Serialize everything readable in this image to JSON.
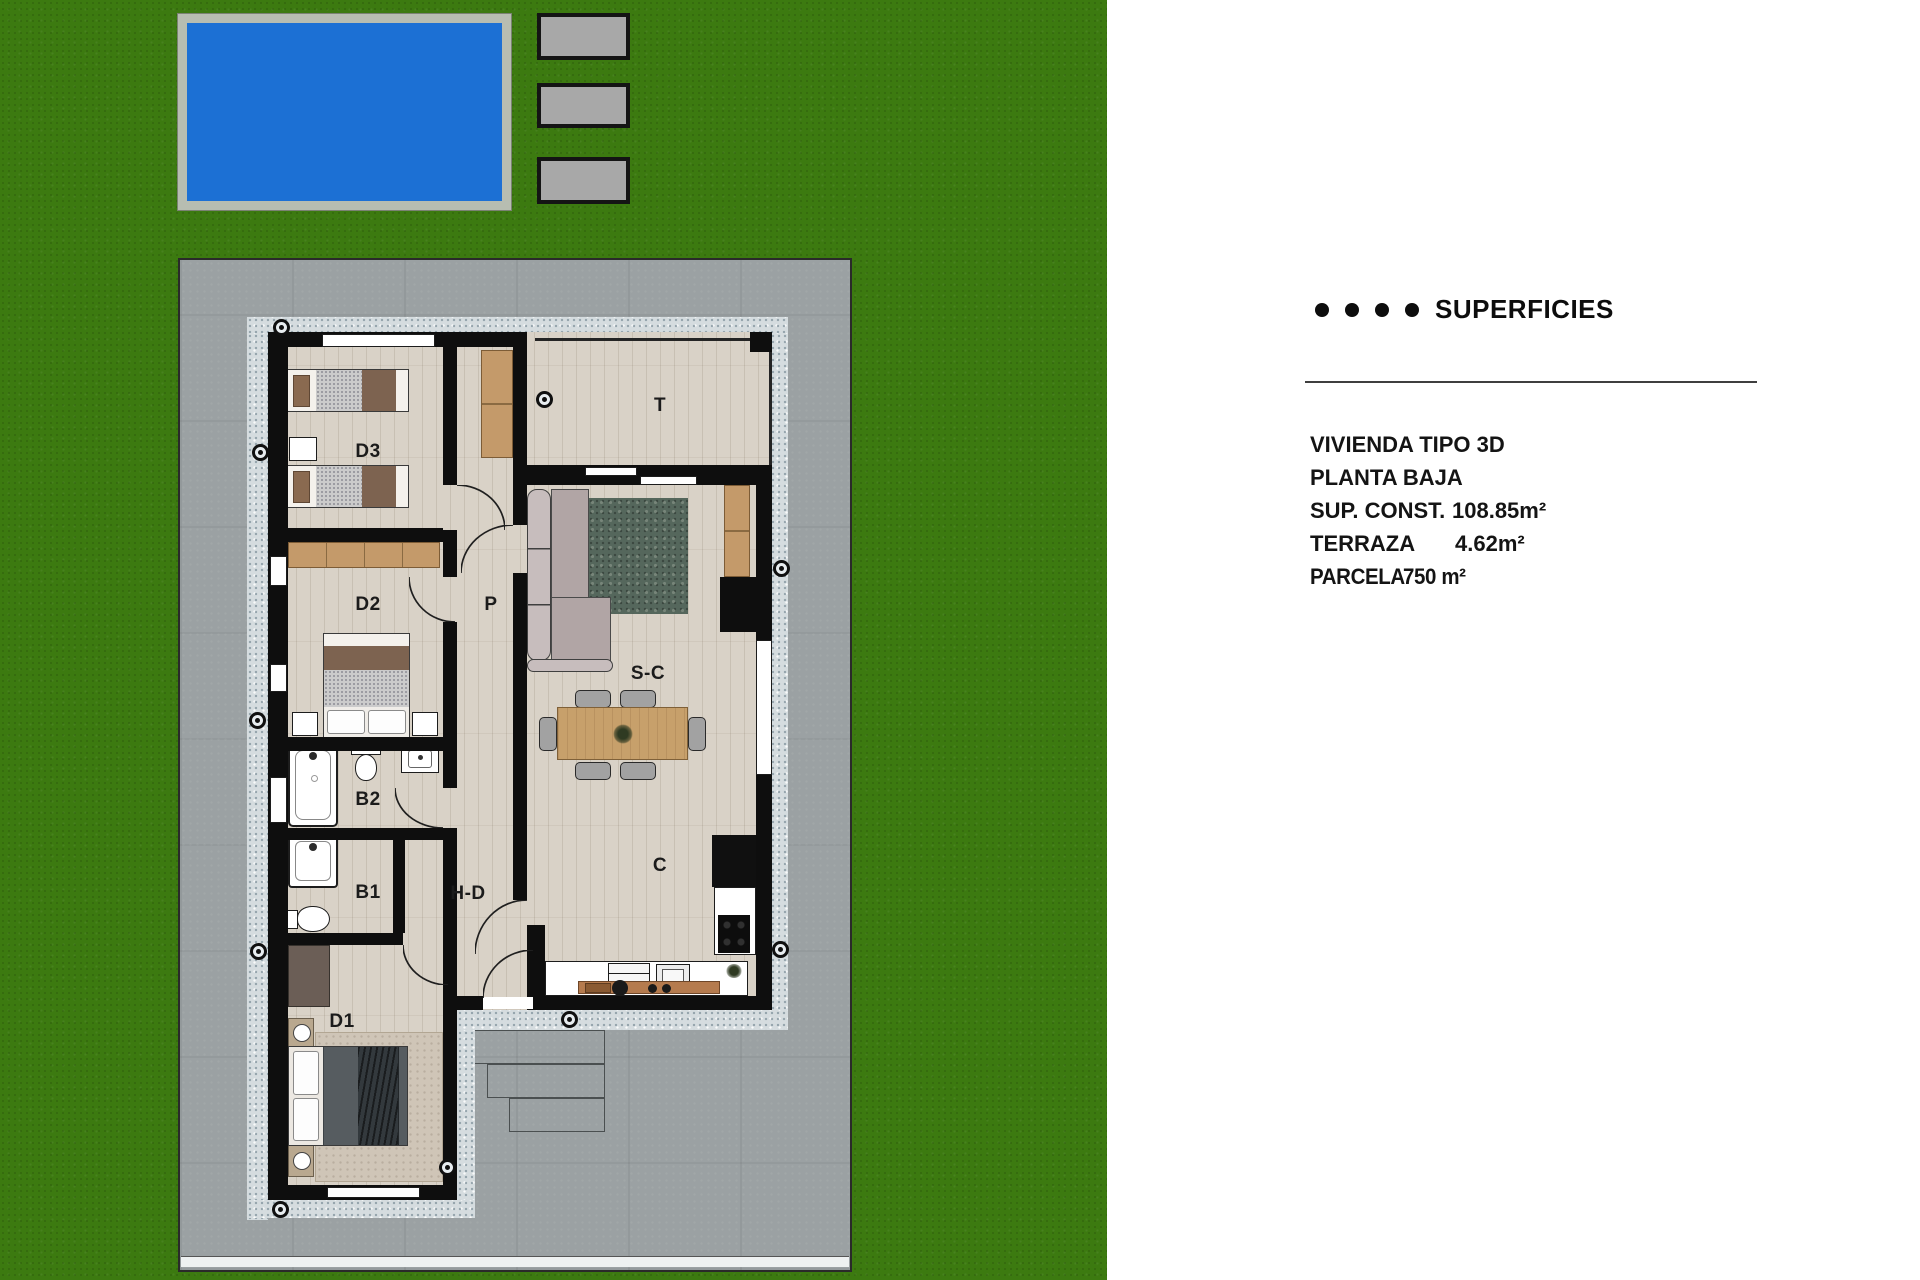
{
  "panel": {
    "title": "SUPERFICIES",
    "lines": [
      {
        "text": "VIVIENDA TIPO 3D"
      },
      {
        "text": "PLANTA BAJA"
      },
      {
        "label": "SUP. CONST.",
        "value": "108.85m²"
      },
      {
        "label": "TERRAZA",
        "value": "4.62m²"
      },
      {
        "label": "PARCELA",
        "value": "750 m²"
      }
    ]
  },
  "plan": {
    "room_labels": [
      {
        "id": "d3",
        "text": "D3",
        "x": 368,
        "y": 452
      },
      {
        "id": "d2",
        "text": "D2",
        "x": 368,
        "y": 605
      },
      {
        "id": "p",
        "text": "P",
        "x": 491,
        "y": 605
      },
      {
        "id": "t",
        "text": "T",
        "x": 660,
        "y": 406
      },
      {
        "id": "sc",
        "text": "S-C",
        "x": 648,
        "y": 674
      },
      {
        "id": "b2",
        "text": "B2",
        "x": 368,
        "y": 800
      },
      {
        "id": "b1",
        "text": "B1",
        "x": 368,
        "y": 893
      },
      {
        "id": "hd",
        "text": "H-D",
        "x": 468,
        "y": 894
      },
      {
        "id": "c",
        "text": "C",
        "x": 660,
        "y": 866
      },
      {
        "id": "d1",
        "text": "D1",
        "x": 342,
        "y": 1022
      }
    ],
    "wall_markers": [
      {
        "x": 282,
        "y": 328
      },
      {
        "x": 261,
        "y": 453
      },
      {
        "x": 258,
        "y": 721
      },
      {
        "x": 259,
        "y": 952
      },
      {
        "x": 281,
        "y": 1210
      },
      {
        "x": 448,
        "y": 1168
      },
      {
        "x": 545,
        "y": 400
      },
      {
        "x": 782,
        "y": 569
      },
      {
        "x": 781,
        "y": 950
      },
      {
        "x": 570,
        "y": 1020
      }
    ]
  },
  "colors": {
    "lawn": "#3c7a10",
    "pool": "#1c70d4",
    "pool_border": "#b7bdb1",
    "garage_card": "#a8a8a8",
    "plot_concrete": "#9ba1a3",
    "walkway": "#d5dcdf",
    "floor": "#d9d2c7",
    "wall": "#0e0e0e",
    "wood": "#c49a6a",
    "rug_living": "#55675c",
    "sofa": "#b1a5a5",
    "label_text": "#1b1b1b"
  }
}
